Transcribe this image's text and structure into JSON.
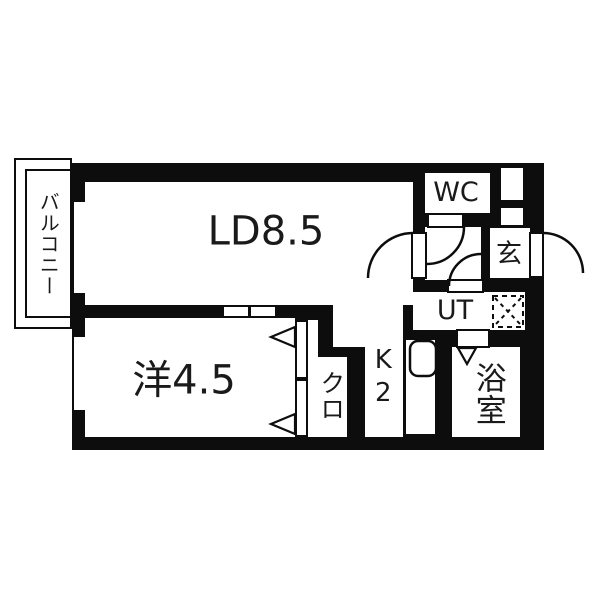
{
  "plan": {
    "rooms": {
      "balcony": {
        "label": "バルコニー"
      },
      "living_dining": {
        "label": "LD8.5"
      },
      "western_room": {
        "label": "洋4.5"
      },
      "kitchen": {
        "label": "K2"
      },
      "closet": {
        "label": "クロ"
      },
      "toilet": {
        "label": "WC"
      },
      "entrance": {
        "label": "玄"
      },
      "utility": {
        "label": "UT"
      },
      "bathroom": {
        "label": "浴室"
      }
    },
    "colors": {
      "wall": "#0d0d0d",
      "floor": "#ffffff",
      "background": "#ffffff"
    }
  }
}
